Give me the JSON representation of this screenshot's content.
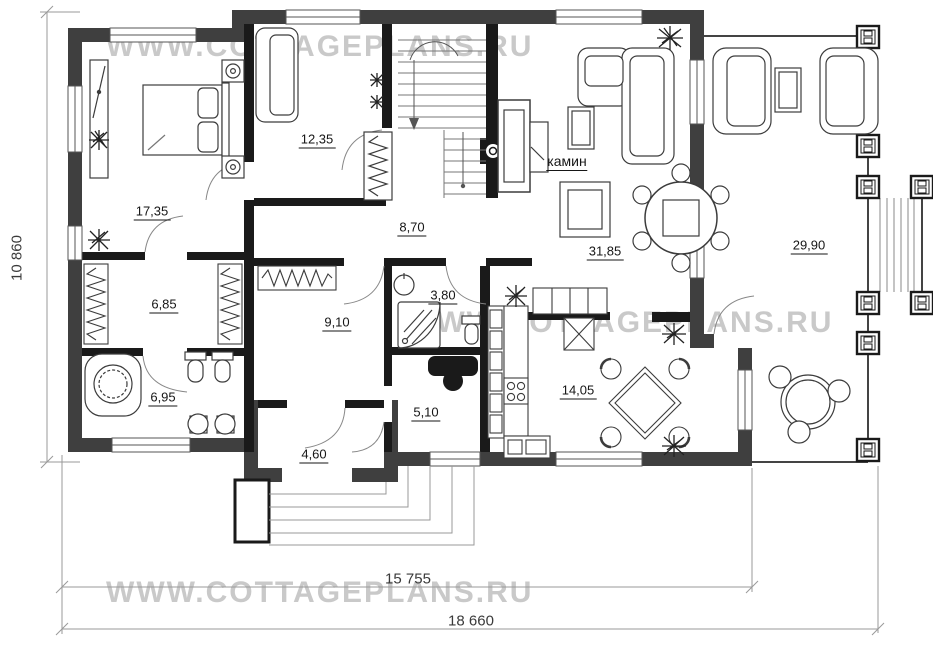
{
  "watermark": {
    "text": "WWW.COTTAGEPLANS.RU"
  },
  "dimensions": {
    "height_total": "10 860",
    "width_inner": "15 755",
    "width_total": "18 660"
  },
  "rooms": [
    {
      "name": "bedroom",
      "area": "17,35"
    },
    {
      "name": "wardrobe-room",
      "area": "12,35"
    },
    {
      "name": "hallway",
      "area": "8,70"
    },
    {
      "name": "dressing-room",
      "area": "6,85"
    },
    {
      "name": "closet-room",
      "area": "9,10"
    },
    {
      "name": "shower-room",
      "area": "3,80"
    },
    {
      "name": "bathroom",
      "area": "6,95"
    },
    {
      "name": "utility-room",
      "area": "5,10"
    },
    {
      "name": "entry",
      "area": "4,60"
    },
    {
      "name": "kitchen",
      "area": "14,05"
    },
    {
      "name": "living-room",
      "area": "31,85"
    },
    {
      "name": "terrace",
      "area": "29,90"
    }
  ],
  "labels": {
    "fireplace": "камин"
  },
  "colors": {
    "exterior_wall": "#3f3f3f",
    "interior_wall": "#1a1a1a",
    "watermark": "#c9c9c9",
    "drawing_line": "#3c3c3c",
    "dim_line": "#999999"
  }
}
